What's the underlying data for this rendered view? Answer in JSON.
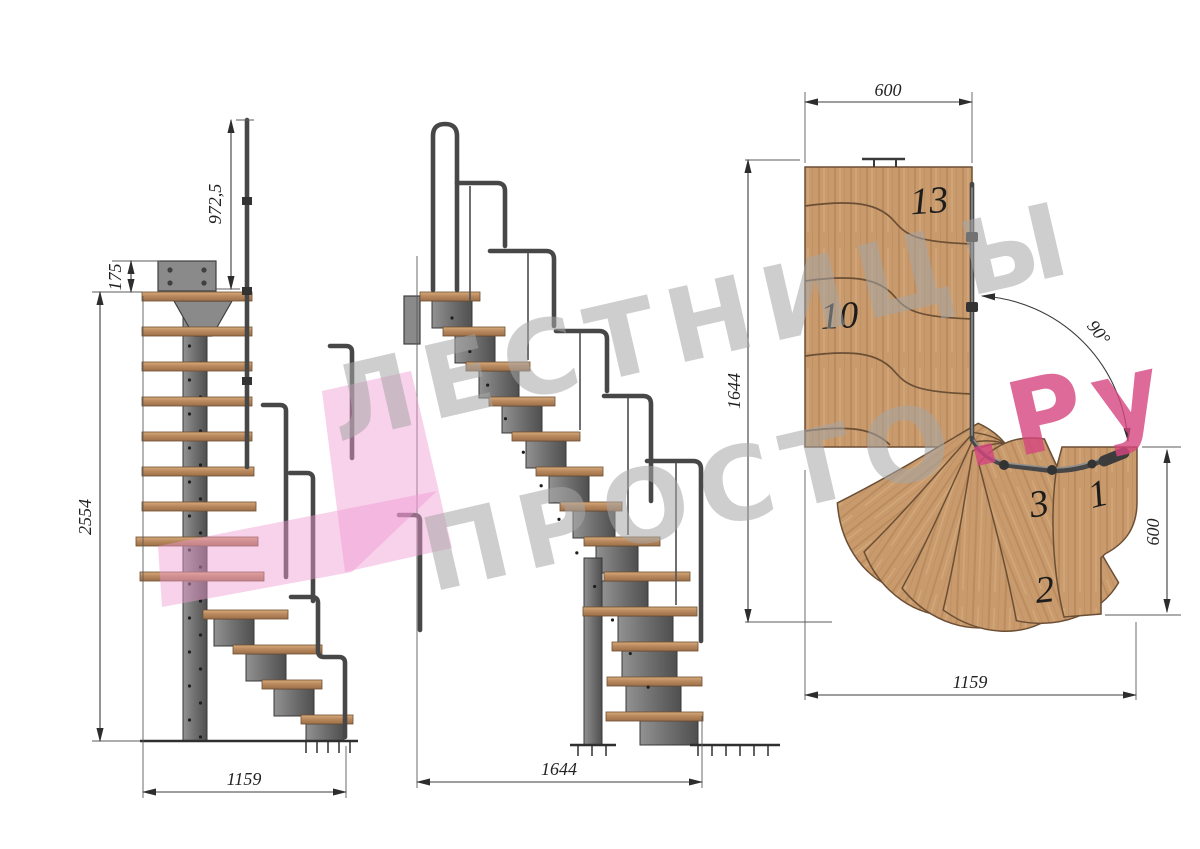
{
  "side_view": {
    "dims": {
      "handrail_height": "972,5",
      "landing_offset": "175",
      "total_height": "2554",
      "footprint_depth": "1159"
    }
  },
  "front_view": {
    "dims": {
      "footprint_width": "1644"
    }
  },
  "plan_view": {
    "dims": {
      "landing_width": "600",
      "plan_length": "1644",
      "turn_angle": "90°",
      "tread_width": "600",
      "plan_width": "1159"
    },
    "tread_numbers": {
      "top": "13",
      "middle": "10",
      "third": "3",
      "first": "1",
      "second": "2"
    }
  },
  "watermark": {
    "line1": "ЛЕСТНИЦЫ",
    "line2": "ПРОСТО",
    "suffix": ".Ру"
  },
  "colors": {
    "wood_base": "#c89a6c",
    "metal": "#6e6e6e",
    "dim_line": "#3c3c3c",
    "watermark_gray": "#a6a6a6",
    "watermark_pink": "#f09ad2",
    "watermark_red": "#d6457f"
  }
}
